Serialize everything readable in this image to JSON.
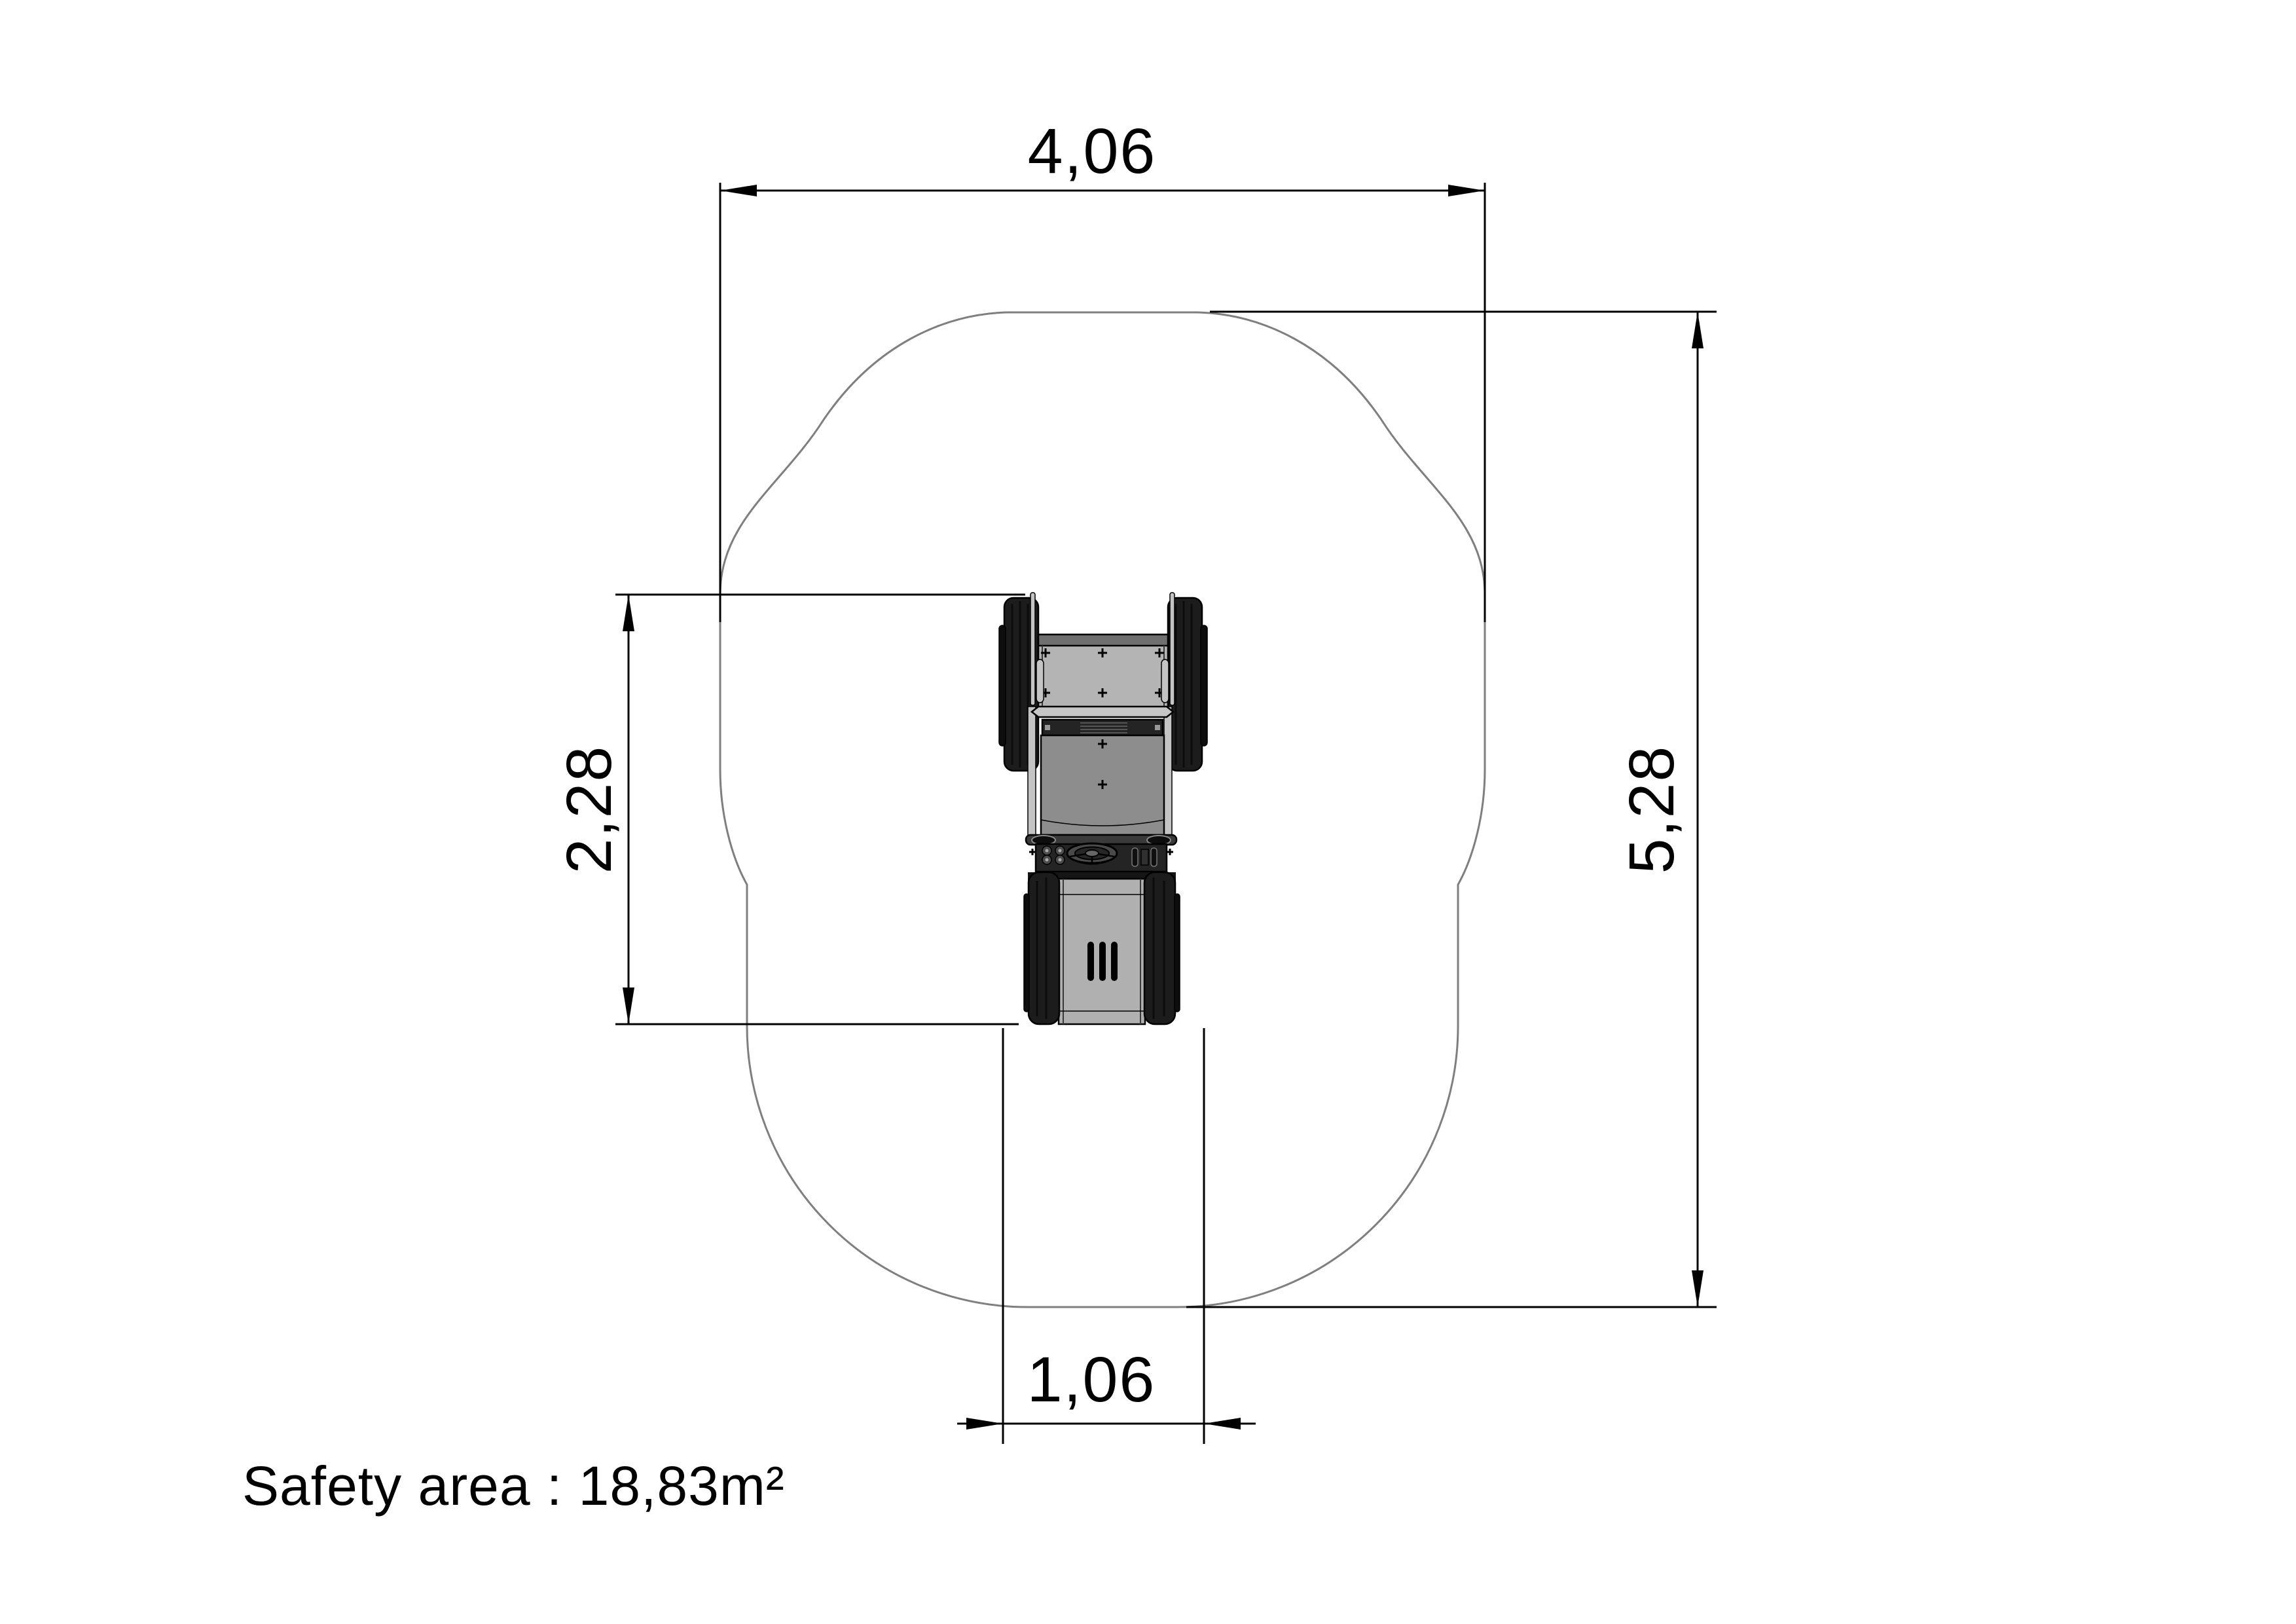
{
  "page": {
    "background": "#ffffff"
  },
  "colors": {
    "ink": "#000000",
    "outline": "#7f7f7f",
    "wheel": "#1c1c1c",
    "wheelcap": "#0d0d0d",
    "bodylight": "#b4b4b4",
    "bodymid": "#8d8d8d",
    "bodydark": "#6f6f6f",
    "paneldark": "#242424",
    "bar": "#3a3a3a",
    "rail": "#c4c4c4",
    "deck": "#b0b0b0",
    "knob": "#4c4c4c"
  },
  "dimensions": {
    "top_width": "4,06",
    "overall_height": "5,28",
    "machine_length": "2,28",
    "machine_width": "1,06"
  },
  "annotations": {
    "safety_area": "Safety area : 18,83m²"
  }
}
